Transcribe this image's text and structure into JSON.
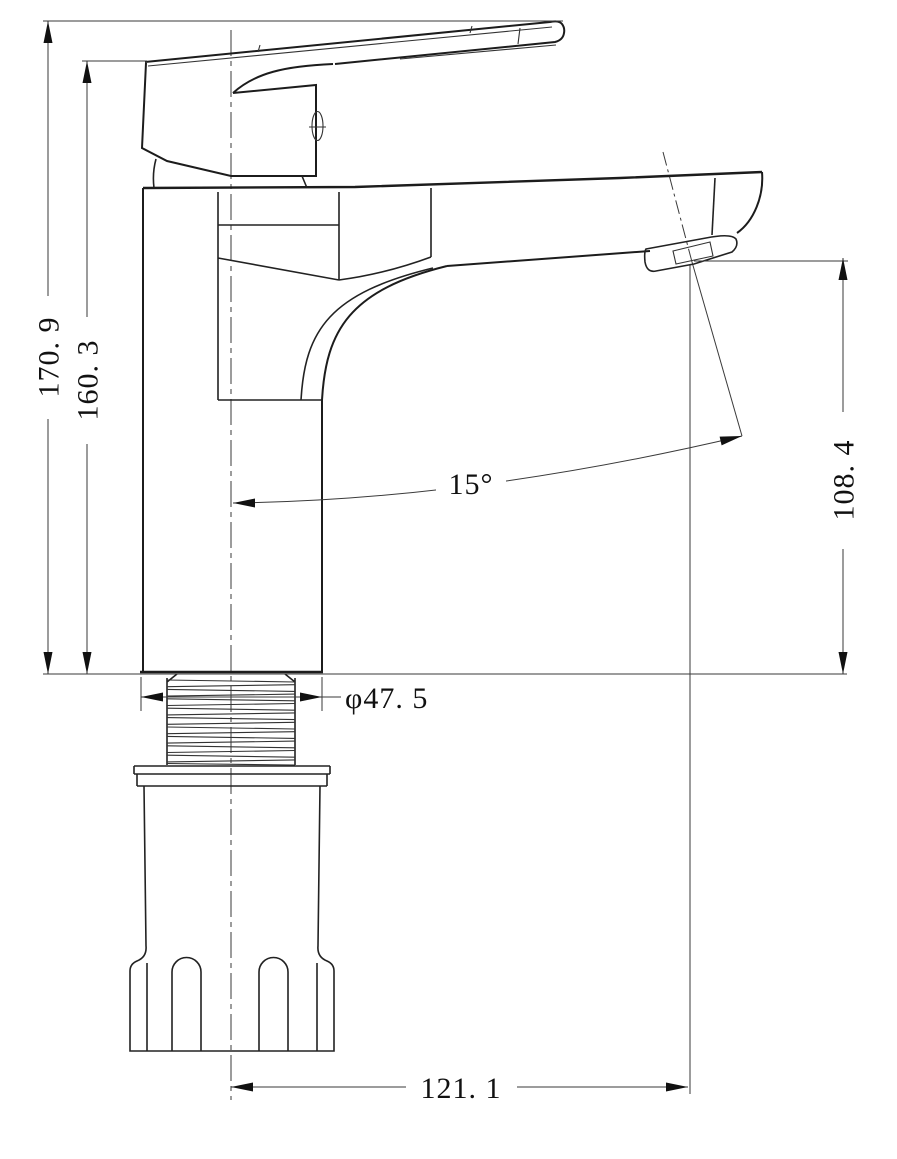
{
  "drawing": {
    "type": "technical-dimension-drawing",
    "subject": "single-lever basin faucet, front elevation",
    "background": "#ffffff",
    "line_color": "#1c1c1c",
    "dimension_color": "#111111",
    "labels": {
      "overall_height": "170. 9",
      "body_height": "160. 3",
      "spout_height": "108. 4",
      "spout_angle": "15°",
      "thread_diameter": "φ47. 5",
      "spout_reach": "121. 1"
    }
  }
}
